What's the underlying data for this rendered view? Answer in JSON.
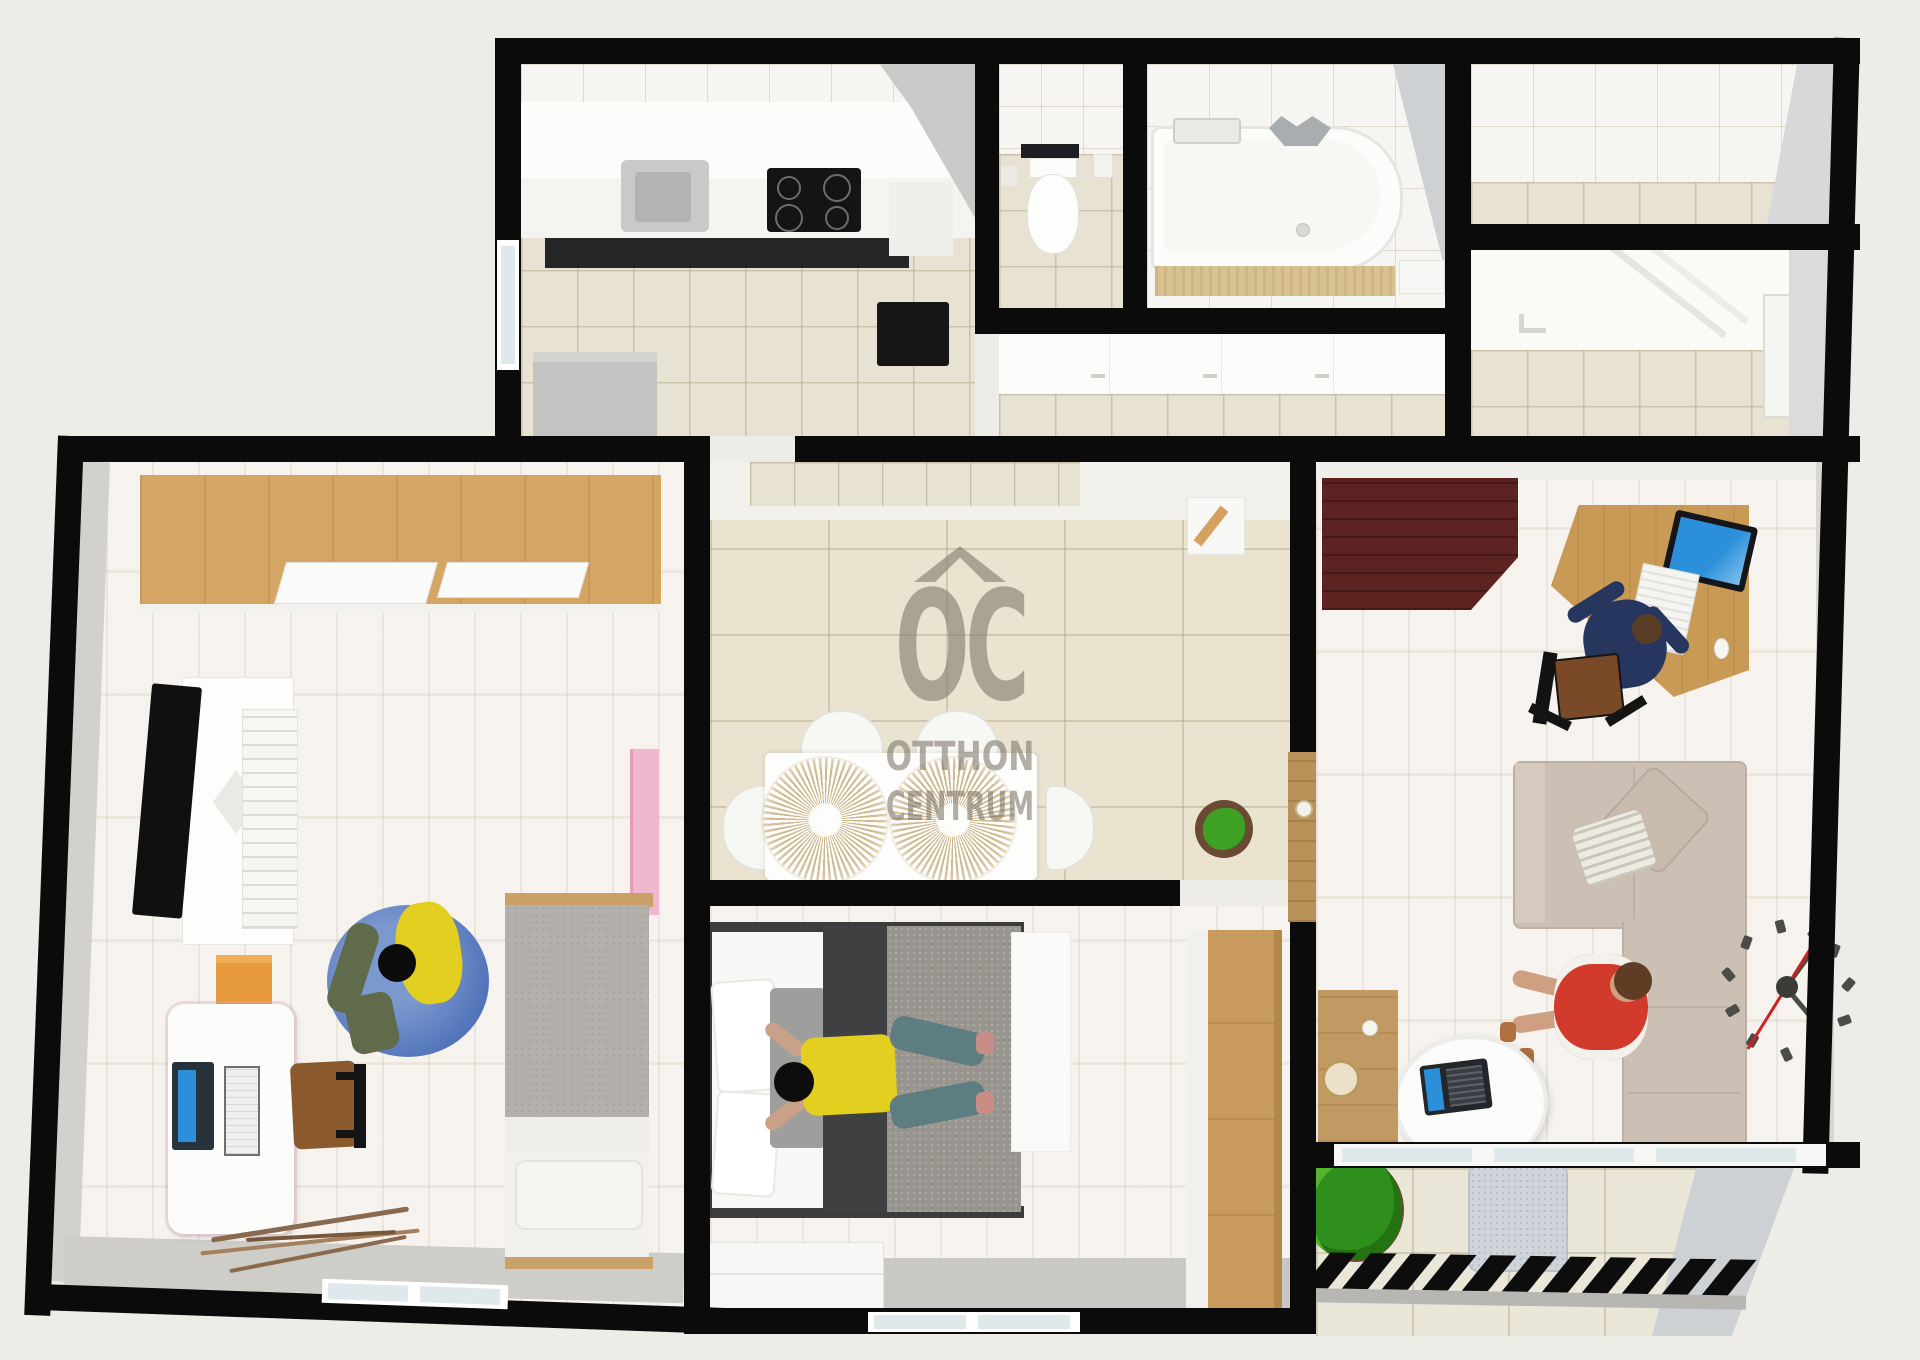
{
  "watermark": {
    "logo": "OC",
    "line1": "OTTHON",
    "line2": "CENTRUM",
    "color": "#7d7568"
  },
  "palette": {
    "wall": "#0b0b0b",
    "background": "#edece7",
    "floor_tile": "#e8e2d2",
    "floor_wood": "#f2ede5",
    "wardrobe_wood": "#d5a564",
    "dark_cabinet": "#5c2320",
    "sofa": "#ccc0b5",
    "bean_bag_blue": "#5577bb",
    "shirt_yellow": "#e3cf1f",
    "shirt_red": "#d23b2c",
    "screen_blue": "#2b8fd9",
    "plant_green": "#3fa226",
    "shelf_pink": "#f0b7cf",
    "clock_red": "#cc2222"
  }
}
